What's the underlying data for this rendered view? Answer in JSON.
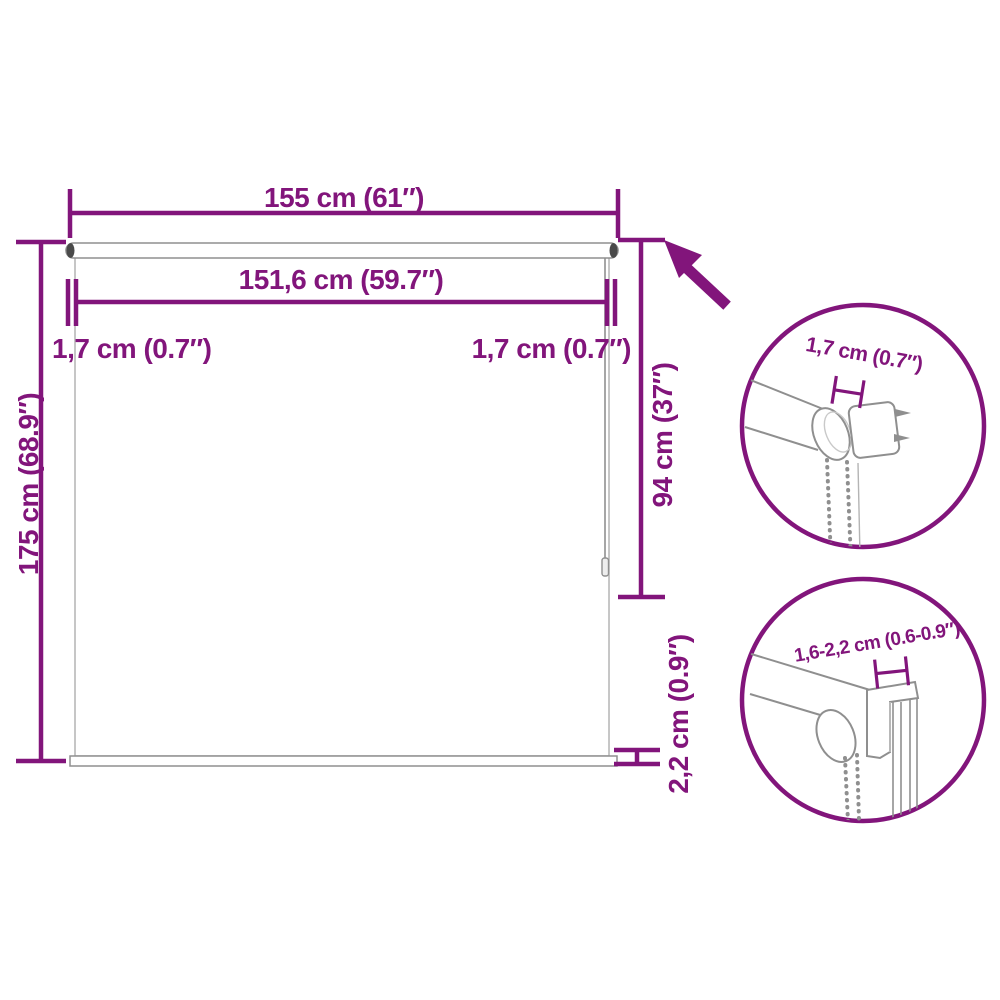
{
  "diagram": {
    "title": "Roller blind dimension diagram",
    "colors": {
      "accent": "#82157b",
      "outline_gray": "#8f8f8f",
      "light_gray": "#b4b4b4",
      "background": "#ffffff"
    },
    "dimensions": {
      "total_width": "155 cm (61″)",
      "fabric_width": "151,6 cm (59.7″)",
      "side_offset_left": "1,7 cm (0.7″)",
      "side_offset_right": "1,7 cm (0.7″)",
      "total_height": "175 cm (68.9″)",
      "chain_length": "94 cm (37″)",
      "bottom_bar_height": "2,2 cm (0.9″)"
    },
    "details": {
      "top_circle_label": "1,7 cm (0.7″)",
      "bottom_circle_label": "1,6-2,2 cm (0.6-0.9″)"
    },
    "icons": {
      "arrow": "zoom-callout-arrow-up-left"
    }
  }
}
